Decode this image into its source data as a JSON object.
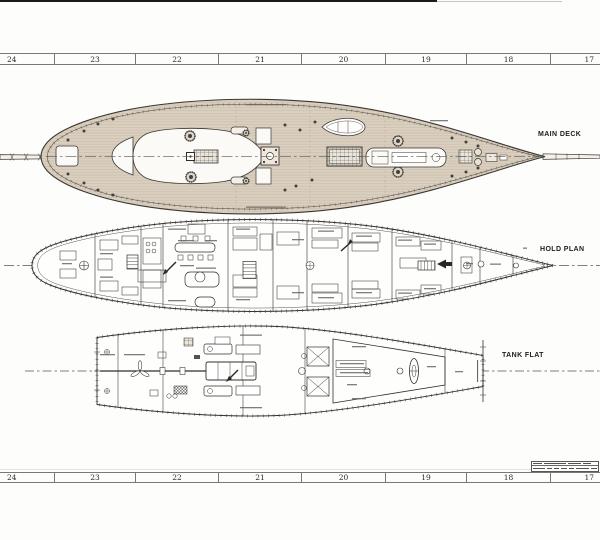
{
  "sheet": {
    "type": "ship-plan-drawing"
  },
  "ruler_top": {
    "numbers": [
      "24",
      "23",
      "22",
      "21",
      "20",
      "19",
      "18",
      "17"
    ]
  },
  "ruler_bottom": {
    "numbers": [
      "24",
      "23",
      "22",
      "21",
      "20",
      "19",
      "18",
      "17"
    ]
  },
  "plans": {
    "main_deck": {
      "label": "MAIN DECK"
    },
    "hold_plan": {
      "label": "HOLD PLAN"
    },
    "tank_flat": {
      "label": "TANK FLAT"
    }
  },
  "colors": {
    "paper": "#fdfdfc",
    "ink": "#3b3733",
    "ink_light": "#6a655f",
    "deck": "#dbd0c0",
    "plank": "#c6b9a5",
    "ruler_line": "#7a7774"
  }
}
